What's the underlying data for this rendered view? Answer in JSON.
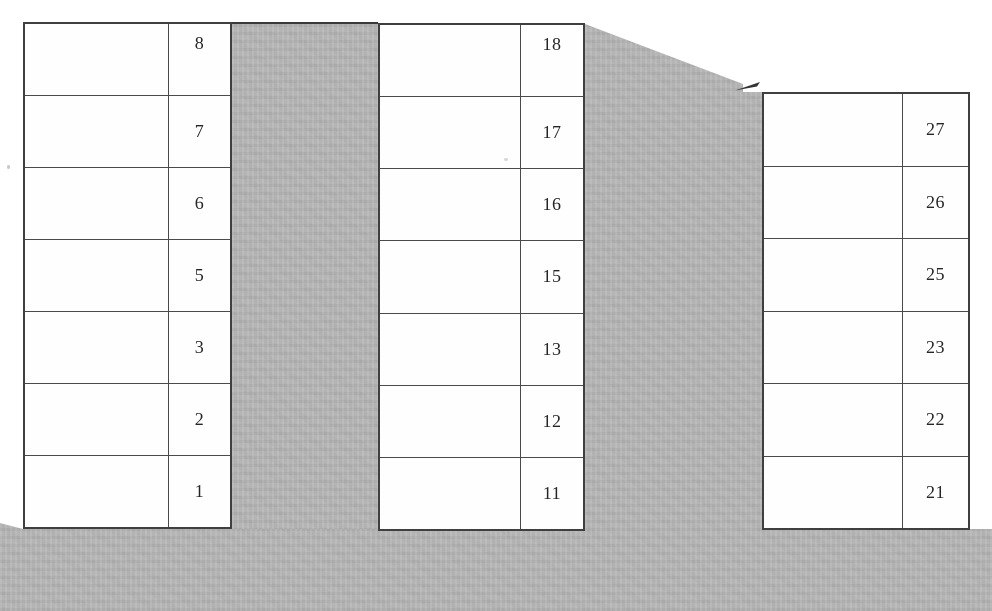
{
  "scene": {
    "description": "Scanned diagram of three buildings drawn as tall two-column tables; right column of each table lists floor numbers (digit 4 skipped in each decade)",
    "colors": {
      "paper": "#ffffff",
      "shade_gray": "#b5b5b5",
      "table_line": "#3f3f3f",
      "digit": "#262626"
    }
  },
  "buildings": [
    {
      "id": "building-1",
      "floors": [
        "8",
        "7",
        "6",
        "5",
        "3",
        "2",
        "1"
      ]
    },
    {
      "id": "building-2",
      "floors": [
        "18",
        "17",
        "16",
        "15",
        "13",
        "12",
        "11"
      ]
    },
    {
      "id": "building-3",
      "floors": [
        "27",
        "26",
        "25",
        "23",
        "22",
        "21"
      ]
    }
  ]
}
